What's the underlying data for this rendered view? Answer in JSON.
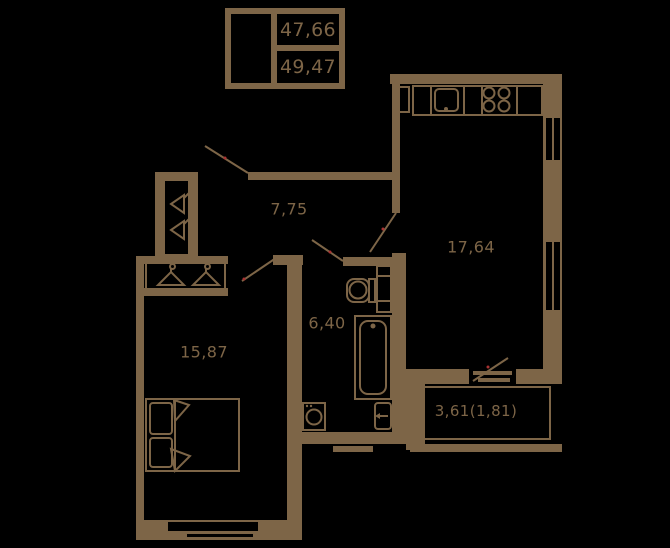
{
  "colors": {
    "background": "#000000",
    "wall": "#7d6547",
    "door_marker": "#a83232"
  },
  "legend": {
    "area_total": "47,66",
    "area_with_balcony": "49,47"
  },
  "rooms": {
    "hallway": {
      "area": "7,75"
    },
    "living_kitchen": {
      "area": "17,64"
    },
    "bathroom": {
      "area": "6,40"
    },
    "bedroom": {
      "area": "15,87"
    },
    "balcony": {
      "area": "3,61(1,81)"
    }
  },
  "fixtures": {
    "stove": "four-burner-circles",
    "kitchen_sink": "rounded-square-with-drain",
    "fridge": "narrow-cabinet",
    "toilet": "bowl-with-tank-and-duct",
    "bathtub": "double-outline-tub",
    "washing_machine": "square-with-drum",
    "wash_basin": "basin-with-faucet-arrow",
    "bed": "double-bed-two-pillows",
    "closet_hangers": "side-view-hangers",
    "wardrobe_hangers": "front-view-hangers",
    "windows": "double-slot-in-wall",
    "doors": "diagonal-swing-lines"
  }
}
